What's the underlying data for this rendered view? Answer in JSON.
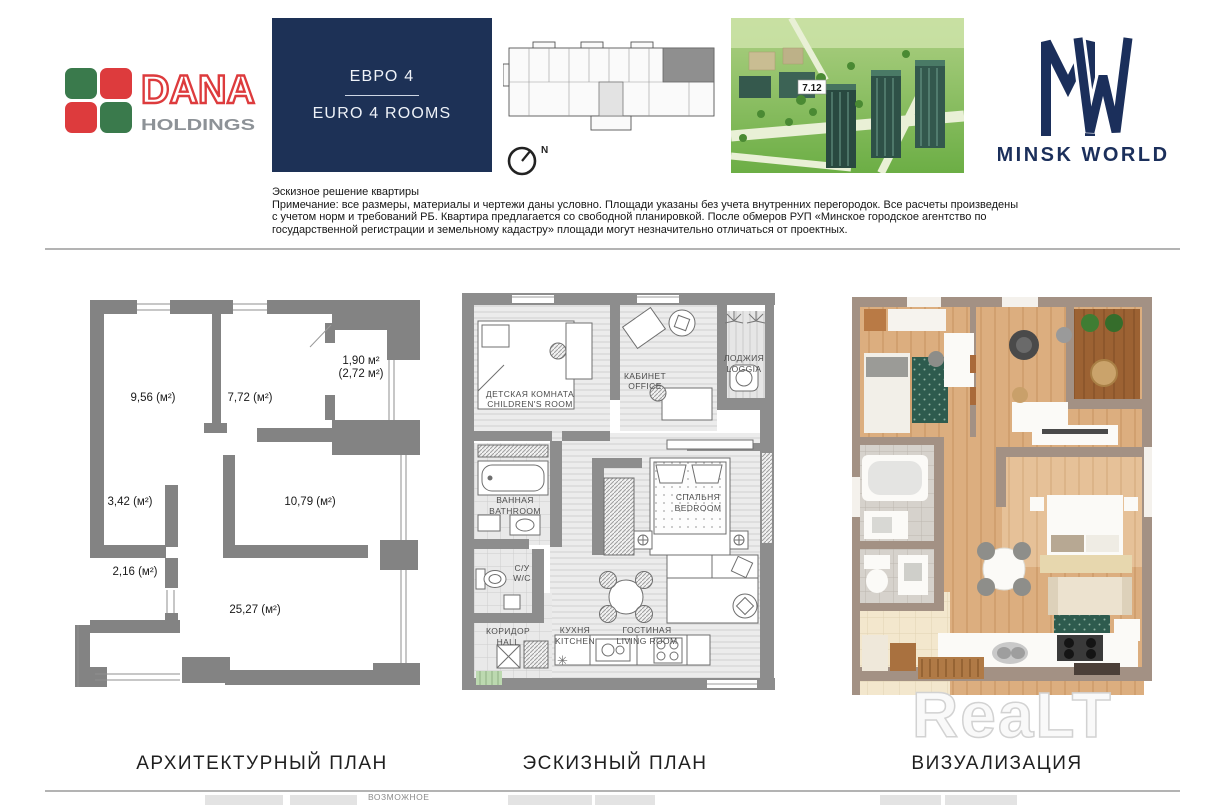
{
  "header": {
    "dana_logo": {
      "name": "DANA",
      "subtitle": "HOLDINGS"
    },
    "unit_box": {
      "title_ru": "ЕВРО 4",
      "title_en": "EURO 4 ROOMS"
    },
    "site_plan": {
      "compass": "N"
    },
    "aerial_view": {
      "building_badge": "7.12"
    },
    "minsk_world_logo": {
      "text": "MINSK WORLD"
    },
    "disclaimer": {
      "title": "Эскизное решение квартиры",
      "line1": "Примечание: все размеры, материалы и чертежи даны условно. Площади указаны без учета внутренних перегородок. Все расчеты произведены",
      "line2": "с учетом норм и требований РБ. Квартира предлагается со свободной планировкой. После обмеров РУП «Минское городское агентство по",
      "line3": "государственной регистрации и земельному кадастру» площади могут незначительно отличаться от проектных."
    }
  },
  "architectural_plan": {
    "caption": "АРХИТЕКТУРНЫЙ ПЛАН",
    "areas": {
      "room_top_left": "9,56 (м²)",
      "room_top_right": "7,72 (м²)",
      "loggia_line1": "1,90 м²",
      "loggia_line2": "(2,72 м²)",
      "room_mid_left": "3,42 (м²)",
      "room_mid_right": "10,79 (м²)",
      "room_small": "2,16 (м²)",
      "room_main": "25,27 (м²)"
    }
  },
  "sketch_plan": {
    "caption": "ЭСКИЗНЫЙ ПЛАН",
    "rooms": {
      "children": {
        "ru": "ДЕТСКАЯ КОМНАТА",
        "en": "CHILDREN'S ROOM"
      },
      "office": {
        "ru": "КАБИНЕТ",
        "en": "OFFICE"
      },
      "loggia": {
        "ru": "ЛОДЖИЯ",
        "en": "LOGGIA"
      },
      "bathroom": {
        "ru": "ВАННАЯ",
        "en": "BATHROOM"
      },
      "bedroom": {
        "ru": "СПАЛЬНЯ",
        "en": "BEDROOM"
      },
      "wc_ru": "С/У",
      "wc_en": "W/C",
      "hall": {
        "ru": "КОРИДОР",
        "en": "HALL"
      },
      "kitchen": {
        "ru": "КУХНЯ",
        "en": "KITCHEN"
      },
      "living": {
        "ru": "ГОСТИНАЯ",
        "en": "LIVING ROOM"
      }
    }
  },
  "visualization": {
    "caption": "ВИЗУАЛИЗАЦИЯ",
    "watermark": "ReaLT"
  },
  "footer": {
    "partial_label": "ВОЗМОЖНОЕ"
  },
  "colors": {
    "brand_navy": "#1d3156",
    "dana_red": "#dd3b3d",
    "dana_green": "#3a7a4c",
    "dana_gray": "#8d9297",
    "plan_wall_gray": "#838383",
    "sketch_wall_gray": "#8d8d8d",
    "render_wall_taupe": "#a39184",
    "render_wood": "#dcae7f",
    "rug_green": "#2e5b4e"
  }
}
